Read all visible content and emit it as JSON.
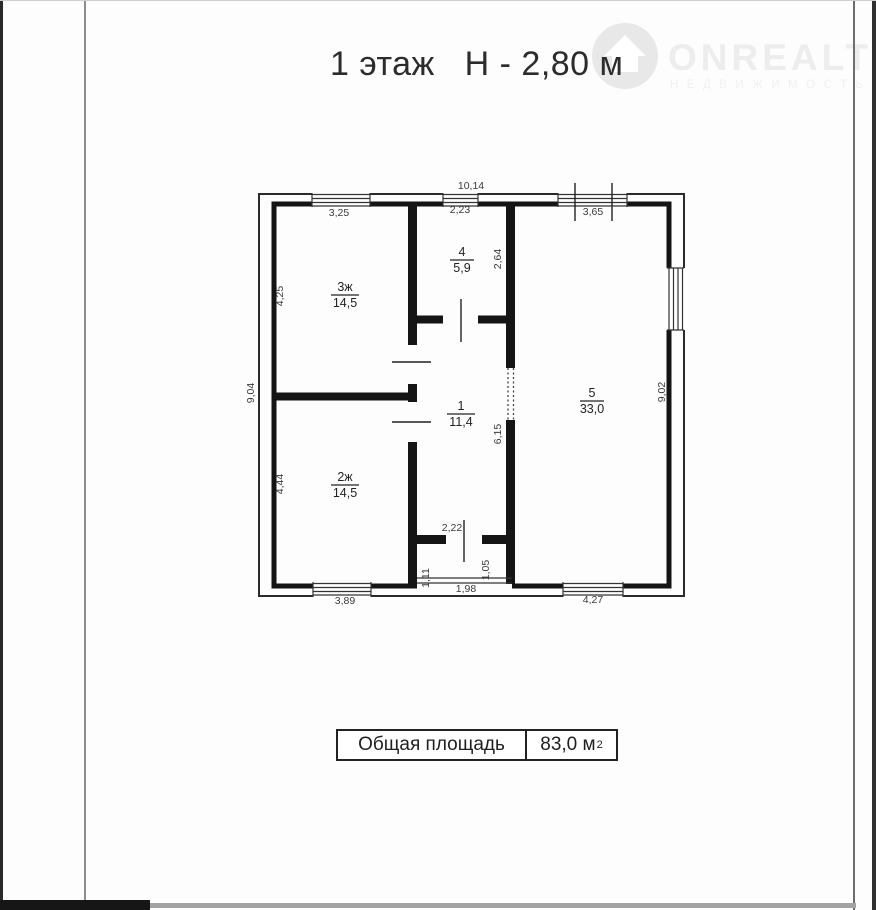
{
  "title": "1 этаж   Н - 2,80 м",
  "logo": {
    "brand": "ONREALT",
    "subtitle": "НЕДВИЖИМОСТЬ",
    "disc_color": "#e8e8e8",
    "text_color": "#ededed"
  },
  "plan": {
    "wall_color": "#1b1b1b",
    "rooms": [
      {
        "num": "3ж",
        "area": "14,5"
      },
      {
        "num": "4",
        "area": "5,9"
      },
      {
        "num": "1",
        "area": "11,4"
      },
      {
        "num": "2ж",
        "area": "14,5"
      },
      {
        "num": "5",
        "area": "33,0"
      }
    ],
    "dims": {
      "top_total": "10,14",
      "top_left": "3,25",
      "top_mid": "2,23",
      "top_right": "3,65",
      "left_total": "9,04",
      "right_total": "9,02",
      "room3_h": "4,25",
      "room2_h": "4,44",
      "room4_h": "2,64",
      "hall_h": "6,15",
      "entry_w": "2,22",
      "porch_left_h": "1,11",
      "porch_right_h": "1,05",
      "porch_w": "1,98",
      "bottom_left": "3,89",
      "bottom_right": "4,27"
    }
  },
  "summary": {
    "label": "Общая площадь",
    "value": "83,0 м",
    "sup": "2"
  }
}
